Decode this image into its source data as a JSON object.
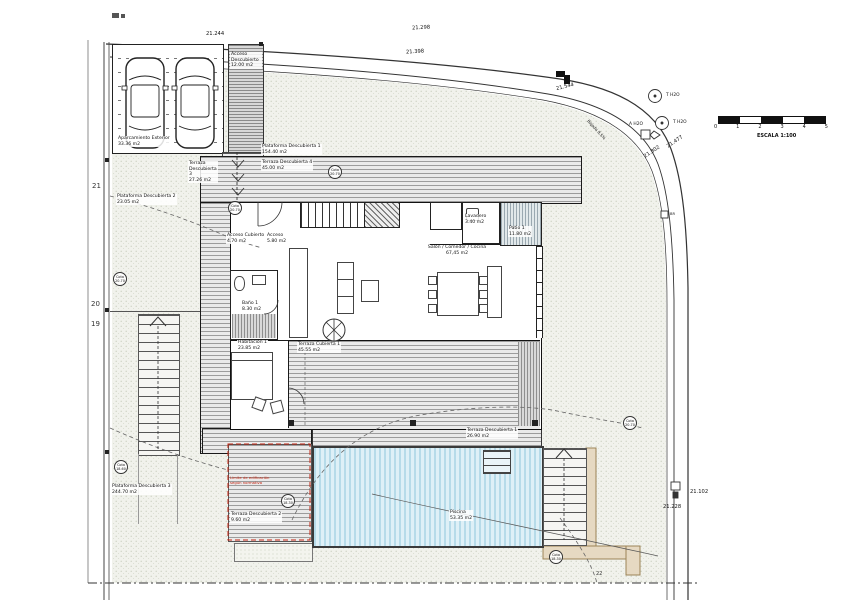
{
  "drawing_title": "Plano de emplazamiento y planta vivienda",
  "colors": {
    "site_stipple": "#ccd1c2",
    "terrace_stripe": "#9c9c9c",
    "pool_blue": "#b6dbe9",
    "red_accent": "#c22310",
    "tan_path": "#e6d9c2",
    "wall": "#1a1a1a"
  },
  "scale": {
    "ticks": [
      "0",
      "1",
      "2",
      "3",
      "4",
      "5"
    ],
    "label": "ESCALA 1:100"
  },
  "dims": {
    "d21244": "21.244",
    "d21298": "21.298",
    "d21398": "21.398",
    "d21544": "21.544",
    "d21477": "21.477",
    "d21802": "21.802",
    "d21102": "21.102",
    "d21228": "21.228"
  },
  "contour_labels": {
    "c21": "21",
    "c20": "20",
    "c19": "19",
    "c22": "22"
  },
  "utilities": {
    "t_h2o_a": "T H2O",
    "t_h2o_b": "T H2O",
    "a_h2o": "A H2O",
    "br": "BR",
    "slope": "Bajada 8,5%"
  },
  "red_note": {
    "line1": "Límite de edificación",
    "line2": "según normativa"
  },
  "areas": {
    "aparcamiento": {
      "name": "Aparcamiento Exterior",
      "area": "33.36 m2"
    },
    "acceso_descubierto": {
      "name": "Acceso Descubierto",
      "area": "12.00 m2"
    },
    "plataforma1": {
      "name": "Plataforma Descubierta 1",
      "area": "154.40 m2"
    },
    "terraza3": {
      "name": "Terraza Descubierta 3",
      "area": "27.26 m2"
    },
    "terraza4": {
      "name": "Terraza Descubierta 4",
      "area": "45.00 m2"
    },
    "plataforma2": {
      "name": "Plataforma Descubierta 2",
      "area": "23.05 m2"
    },
    "plataforma3": {
      "name": "Plataforma Descubierta 3",
      "area": "244.70 m2"
    },
    "acceso_cubierto": {
      "name": "Acceso Cubierto",
      "area": "4.70 m2"
    },
    "acceso": {
      "name": "Acceso",
      "area": "5.80 m2"
    },
    "lavadero": {
      "name": "Lavadero",
      "area": "3.40 m2"
    },
    "patio1": {
      "name": "Patio 1",
      "area": "11.80 m2"
    },
    "salon": {
      "name": "Salón / Comedor / Cocina",
      "area": "67,45 m2"
    },
    "bano1": {
      "name": "Baño 1",
      "area": "8.30 m2"
    },
    "habitacion1": {
      "name": "Habitación 1",
      "area": "23.85 m2"
    },
    "terraza_cubierta1": {
      "name": "Terraza Cubierta 1",
      "area": "45.55 m2"
    },
    "terraza1": {
      "name": "Terraza Descubierta 1",
      "area": "26.90 m2"
    },
    "terraza2": {
      "name": "Terraza Descubierta 2",
      "area": "9.60 m2"
    },
    "piscina": {
      "name": "Piscina",
      "area": "53.35 m2"
    }
  },
  "cotas": {
    "c1": {
      "t": "Cota",
      "v": "20.70"
    },
    "c2": {
      "t": "Cota",
      "v": "20.70"
    },
    "c3": {
      "t": "Cota",
      "v": "20.70"
    },
    "c4": {
      "t": "Cota",
      "v": "20.70"
    },
    "c5": {
      "t": "Cota",
      "v": "18.60"
    },
    "c6": {
      "t": "Cota",
      "v": "18.30"
    },
    "c7": {
      "t": "Cota",
      "v": "18.30"
    }
  }
}
